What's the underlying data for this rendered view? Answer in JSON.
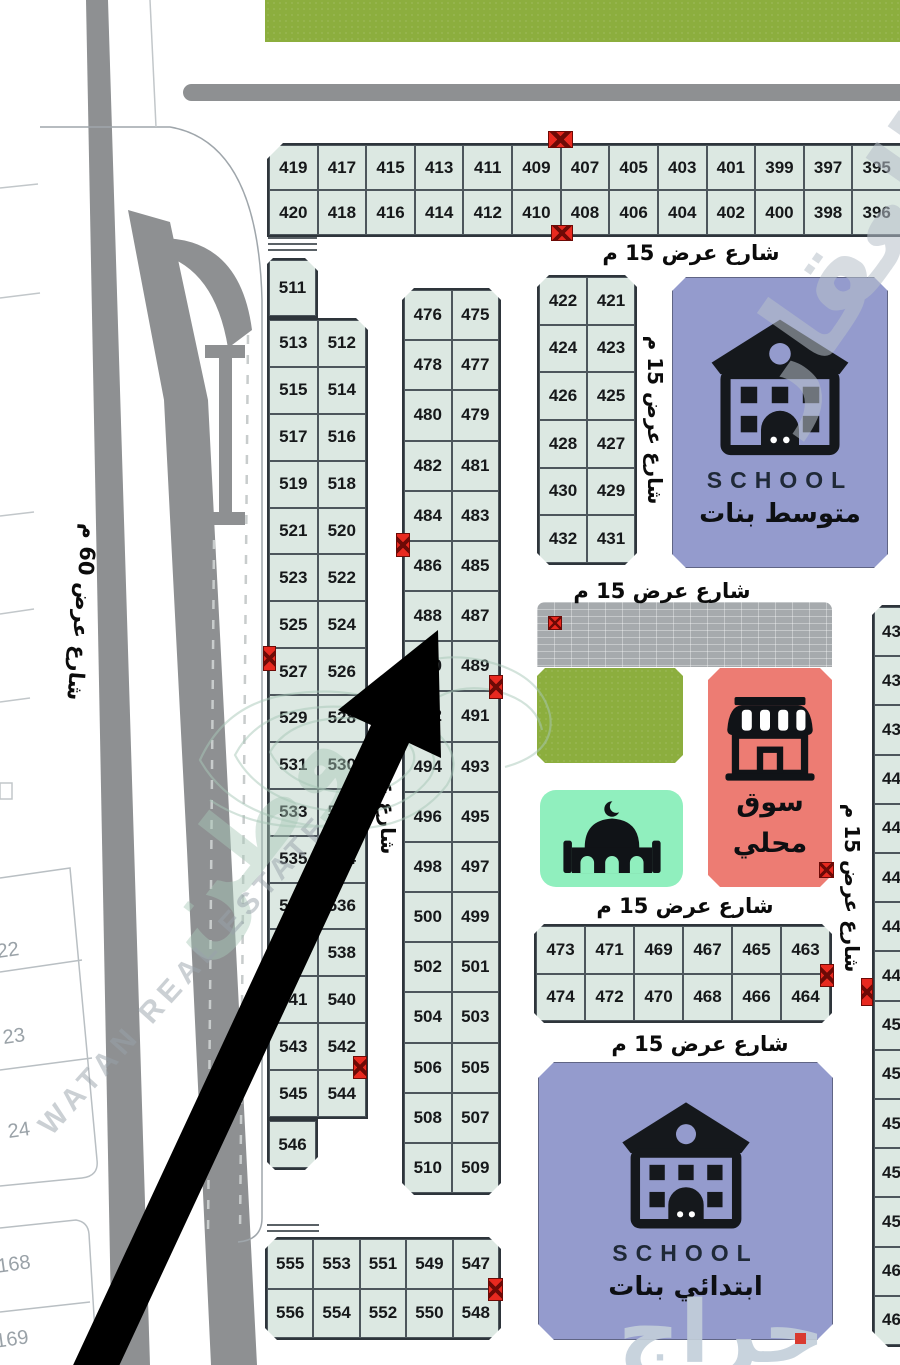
{
  "streets": {
    "w15": "شارع عرض 15 م",
    "w60": "شارع عرض 60 م"
  },
  "blocks": {
    "top": [
      [
        "419",
        "417",
        "415",
        "413",
        "411",
        "409",
        "407",
        "405",
        "403",
        "401",
        "399",
        "397",
        "395"
      ],
      [
        "420",
        "418",
        "416",
        "414",
        "412",
        "410",
        "408",
        "406",
        "404",
        "402",
        "400",
        "398",
        "396"
      ]
    ],
    "left_single_top": [
      "511"
    ],
    "left_pairs": [
      [
        "513",
        "512"
      ],
      [
        "515",
        "514"
      ],
      [
        "517",
        "516"
      ],
      [
        "519",
        "518"
      ],
      [
        "521",
        "520"
      ],
      [
        "523",
        "522"
      ],
      [
        "525",
        "524"
      ],
      [
        "527",
        "526"
      ],
      [
        "529",
        "528"
      ],
      [
        "531",
        "530"
      ],
      [
        "533",
        "532"
      ],
      [
        "535",
        "534"
      ],
      [
        "537",
        "536"
      ],
      [
        "539",
        "538"
      ],
      [
        "541",
        "540"
      ],
      [
        "543",
        "542"
      ],
      [
        "545",
        "544"
      ]
    ],
    "left_single_bottom": [
      "546"
    ],
    "mid_pairs": [
      [
        "476",
        "475"
      ],
      [
        "478",
        "477"
      ],
      [
        "480",
        "479"
      ],
      [
        "482",
        "481"
      ],
      [
        "484",
        "483"
      ],
      [
        "486",
        "485"
      ],
      [
        "488",
        "487"
      ],
      [
        "490",
        "489"
      ],
      [
        "492",
        "491"
      ],
      [
        "494",
        "493"
      ],
      [
        "496",
        "495"
      ],
      [
        "498",
        "497"
      ],
      [
        "500",
        "499"
      ],
      [
        "502",
        "501"
      ],
      [
        "504",
        "503"
      ],
      [
        "506",
        "505"
      ],
      [
        "508",
        "507"
      ],
      [
        "510",
        "509"
      ]
    ],
    "upper_small": [
      [
        "422",
        "421"
      ],
      [
        "424",
        "423"
      ],
      [
        "426",
        "425"
      ],
      [
        "428",
        "427"
      ],
      [
        "430",
        "429"
      ],
      [
        "432",
        "431"
      ]
    ],
    "lower_small": [
      [
        "473",
        "471",
        "469",
        "467",
        "465",
        "463"
      ],
      [
        "474",
        "472",
        "470",
        "468",
        "466",
        "464"
      ]
    ],
    "bottom_left": [
      [
        "555",
        "553",
        "551",
        "549",
        "547"
      ],
      [
        "556",
        "554",
        "552",
        "550",
        "548"
      ]
    ],
    "right_col": [
      "434",
      "436",
      "438",
      "440",
      "442",
      "444",
      "446",
      "448",
      "450",
      "452",
      "454",
      "456",
      "458",
      "460",
      "462"
    ],
    "faint_left": [
      "22",
      "23",
      "24",
      "168",
      "169"
    ]
  },
  "pois": {
    "school_top": {
      "title": "SCHOOL",
      "subtitle": "متوسط بنات"
    },
    "school_bottom": {
      "title": "SCHOOL",
      "subtitle": "ابتدائي بنات"
    },
    "market": {
      "line1": "سوق",
      "line2": "محلي"
    }
  },
  "watermarks": {
    "top_right": "العقار",
    "mid": "وطن",
    "latin": "WATAN REAL ESTATE",
    "bottom_right": "حراج"
  },
  "colors": {
    "plot_fill": "#dce8e2",
    "plot_line": "#4d565c",
    "block_border": "#2e353b",
    "text_dark": "#16181a",
    "school_bg": "#949bcd",
    "school_text": "#1f2937",
    "market_bg": "#ed7c73",
    "mosque_bg": "#90efbe",
    "grass": "#8cae3e",
    "paved": "#a6aaad",
    "road_gray": "#8e9092",
    "marker_red": "#e8291f",
    "marker_dark": "#6d0a06",
    "faint_gray": "#9aa2a8",
    "wm_gray": "#b7c0ca",
    "wm_teal": "#a8c8b8",
    "haraj_blue": "#c3cfda",
    "street_text": "#0b0b0b"
  }
}
